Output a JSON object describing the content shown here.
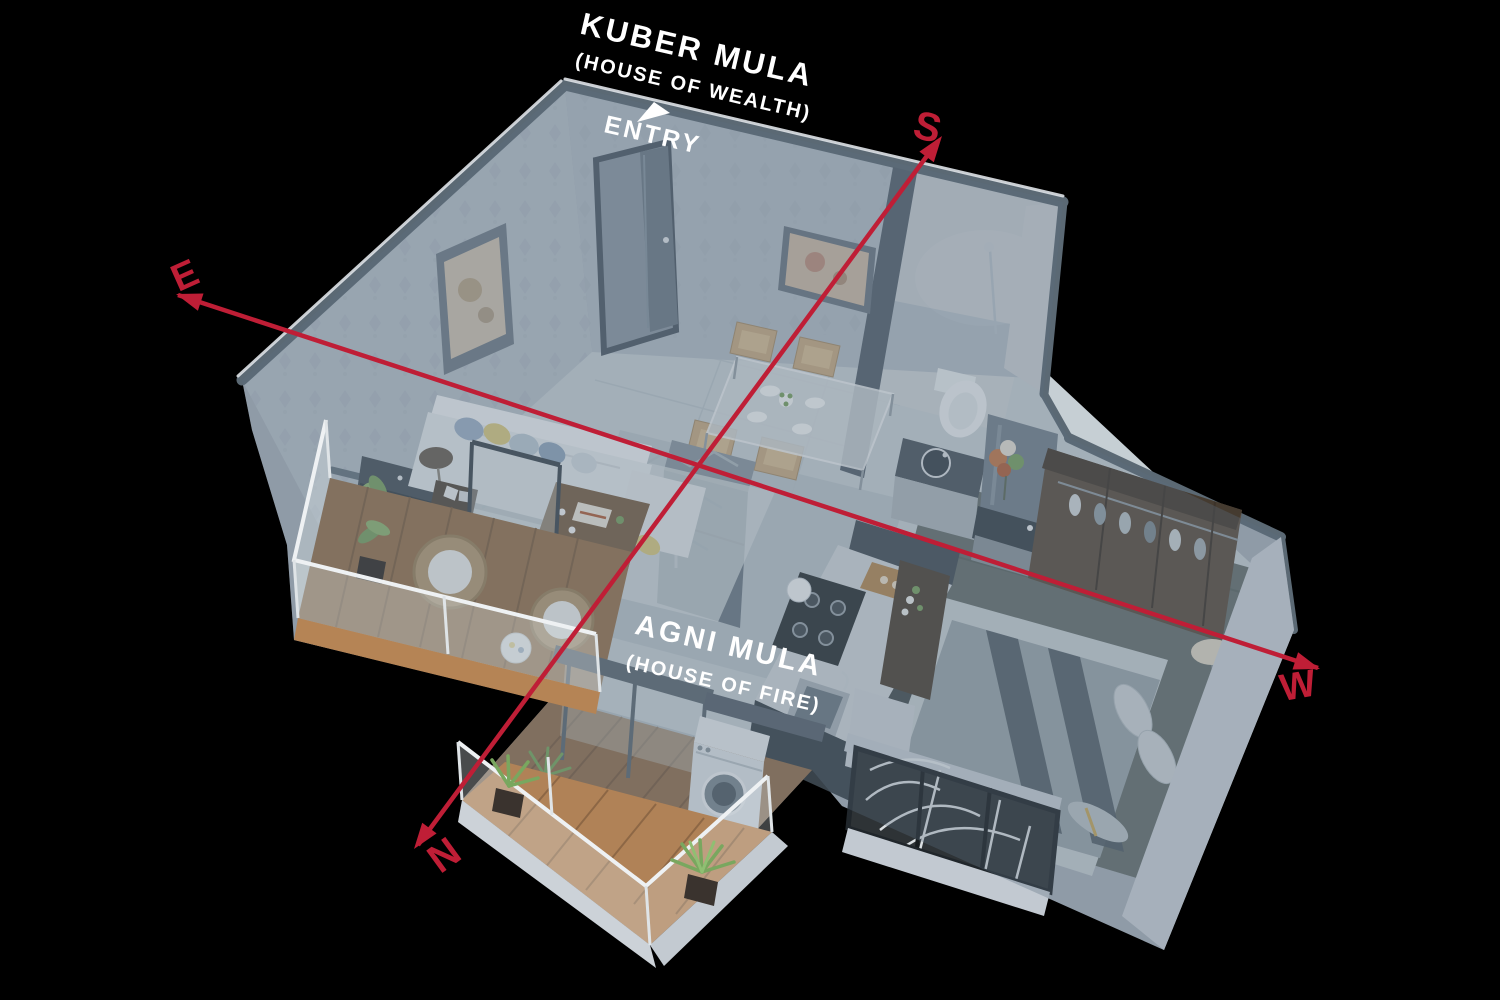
{
  "scene": {
    "labels": {
      "wealth_title": "KUBER MULA",
      "wealth_subtitle": "(HOUSE OF WEALTH)",
      "entry": "ENTRY",
      "fire_title": "AGNI MULA",
      "fire_subtitle": "(HOUSE OF FIRE)"
    },
    "compass": {
      "south": "S",
      "north": "N",
      "east": "E",
      "west": "W"
    },
    "colors": {
      "background": "#000000",
      "compass_red": "#bf1e36",
      "label_white": "#ffffff",
      "glass_tint": "#5a6e80",
      "deck_wood": "#b08257",
      "plant_green": "#7aa263",
      "wall_top": "#5b6974",
      "wall_face": "#b6c0c8"
    }
  }
}
